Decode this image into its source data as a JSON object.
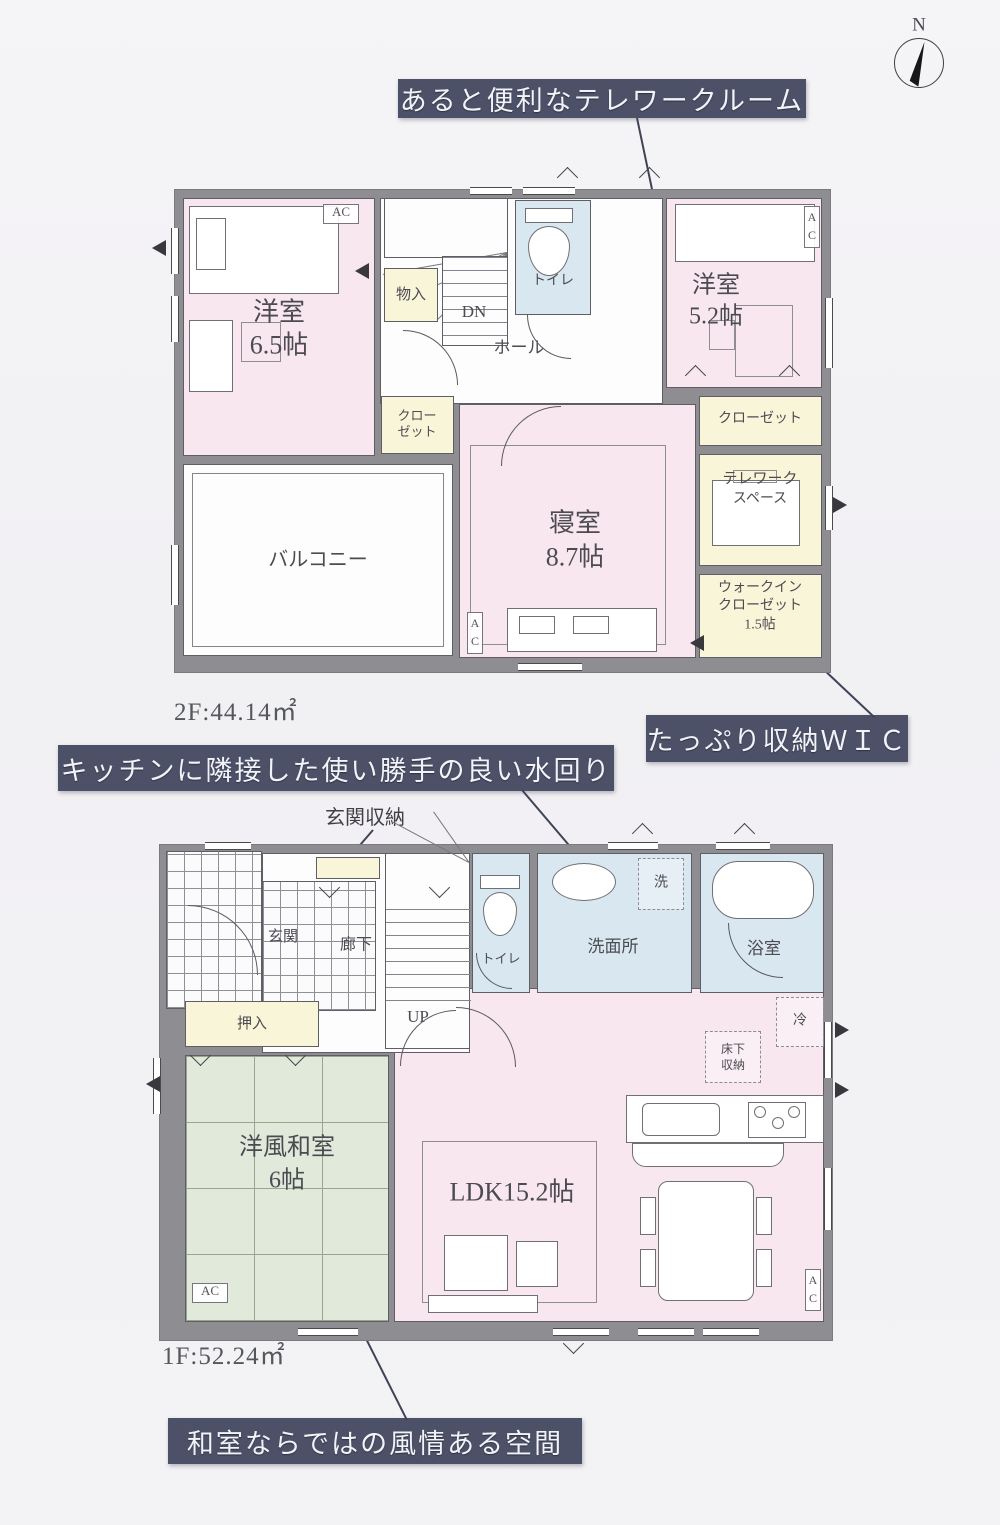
{
  "compass": {
    "north": "N"
  },
  "callouts": {
    "telework": "あると便利なテレワークルーム",
    "wic": "たっぷり収納ＷＩＣ",
    "kitchen": "キッチンに隣接した使い勝手の良い水回り",
    "washitsu": "和室ならではの風情ある空間",
    "genkan_shuno": "玄関収納"
  },
  "floor2": {
    "area": "2F:44.14㎡",
    "youshitsu65": {
      "name": "洋室",
      "size": "6.5帖"
    },
    "monoire": "物入",
    "dn": "DN",
    "hall": "ホール",
    "toilet": "トイレ",
    "youshitsu52": {
      "name": "洋室",
      "size": "5.2帖"
    },
    "closet_right": "クローゼット",
    "closet_left": {
      "l1": "クロー",
      "l2": "ゼット"
    },
    "telework_space": {
      "l1": "テレワーク",
      "l2": "スペース"
    },
    "wic": {
      "l1": "ウォークイン",
      "l2": "クローゼット",
      "l3": "1.5帖"
    },
    "shinshitsu": {
      "name": "寝室",
      "size": "8.7帖"
    },
    "balcony": "バルコニー",
    "ac": "AC"
  },
  "floor1": {
    "area": "1F:52.24㎡",
    "genkan": "玄関",
    "rouka": "廊下",
    "up": "UP",
    "toilet": "トイレ",
    "senmenjo": "洗面所",
    "laundry": "洗",
    "bath": "浴室",
    "oshiire": "押入",
    "washitsu": {
      "name": "洋風和室",
      "size": "6帖"
    },
    "ldk": "LDK15.2帖",
    "underfloor": {
      "l1": "床下",
      "l2": "収納"
    },
    "fridge": "冷",
    "ac": "AC"
  }
}
